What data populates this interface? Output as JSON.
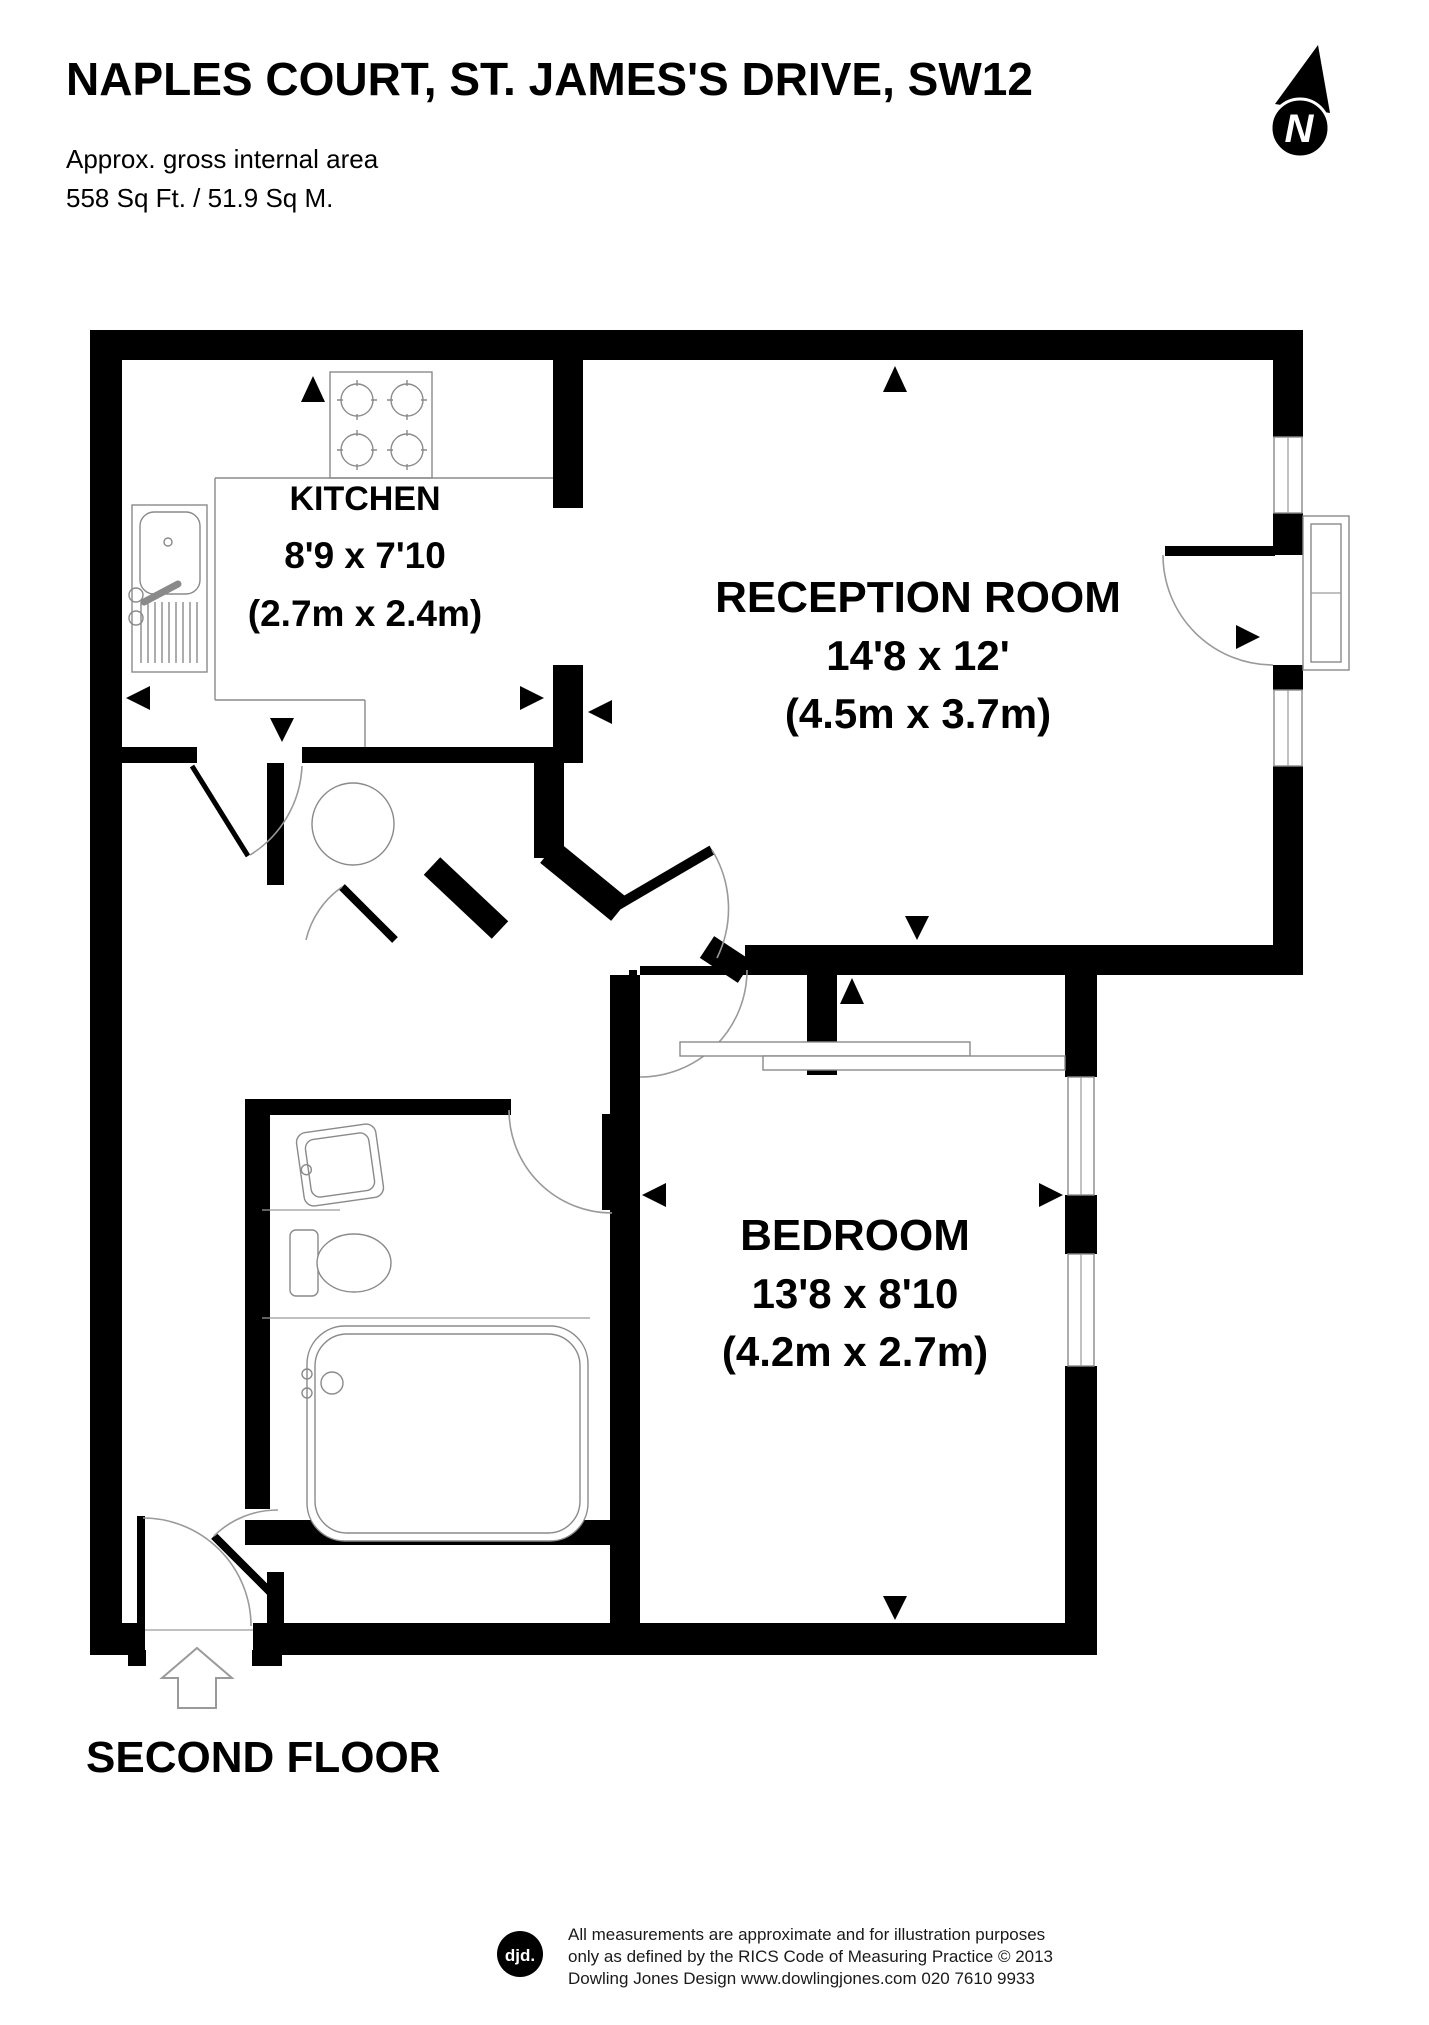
{
  "header": {
    "title": "NAPLES COURT, ST. JAMES'S DRIVE, SW12",
    "area_label": "Approx. gross internal area",
    "area_value": "558 Sq Ft. / 51.9 Sq M."
  },
  "compass": {
    "label": "N"
  },
  "rooms": [
    {
      "name": "KITCHEN",
      "imperial": "8'9 x 7'10",
      "metric": "(2.7m x 2.4m)"
    },
    {
      "name": "RECEPTION ROOM",
      "imperial": "14'8 x 12'",
      "metric": "(4.5m x 3.7m)"
    },
    {
      "name": "BEDROOM",
      "imperial": "13'8 x 8'10",
      "metric": "(4.2m x 2.7m)"
    }
  ],
  "floor_label": "SECOND FLOOR",
  "footer": {
    "logo": "djd.",
    "line1": "All measurements are approximate and for illustration purposes",
    "line2": "only as defined by the RICS Code of Measuring Practice © 2013",
    "line3": "Dowling Jones Design www.dowlingjones.com 020 7610 9933"
  }
}
